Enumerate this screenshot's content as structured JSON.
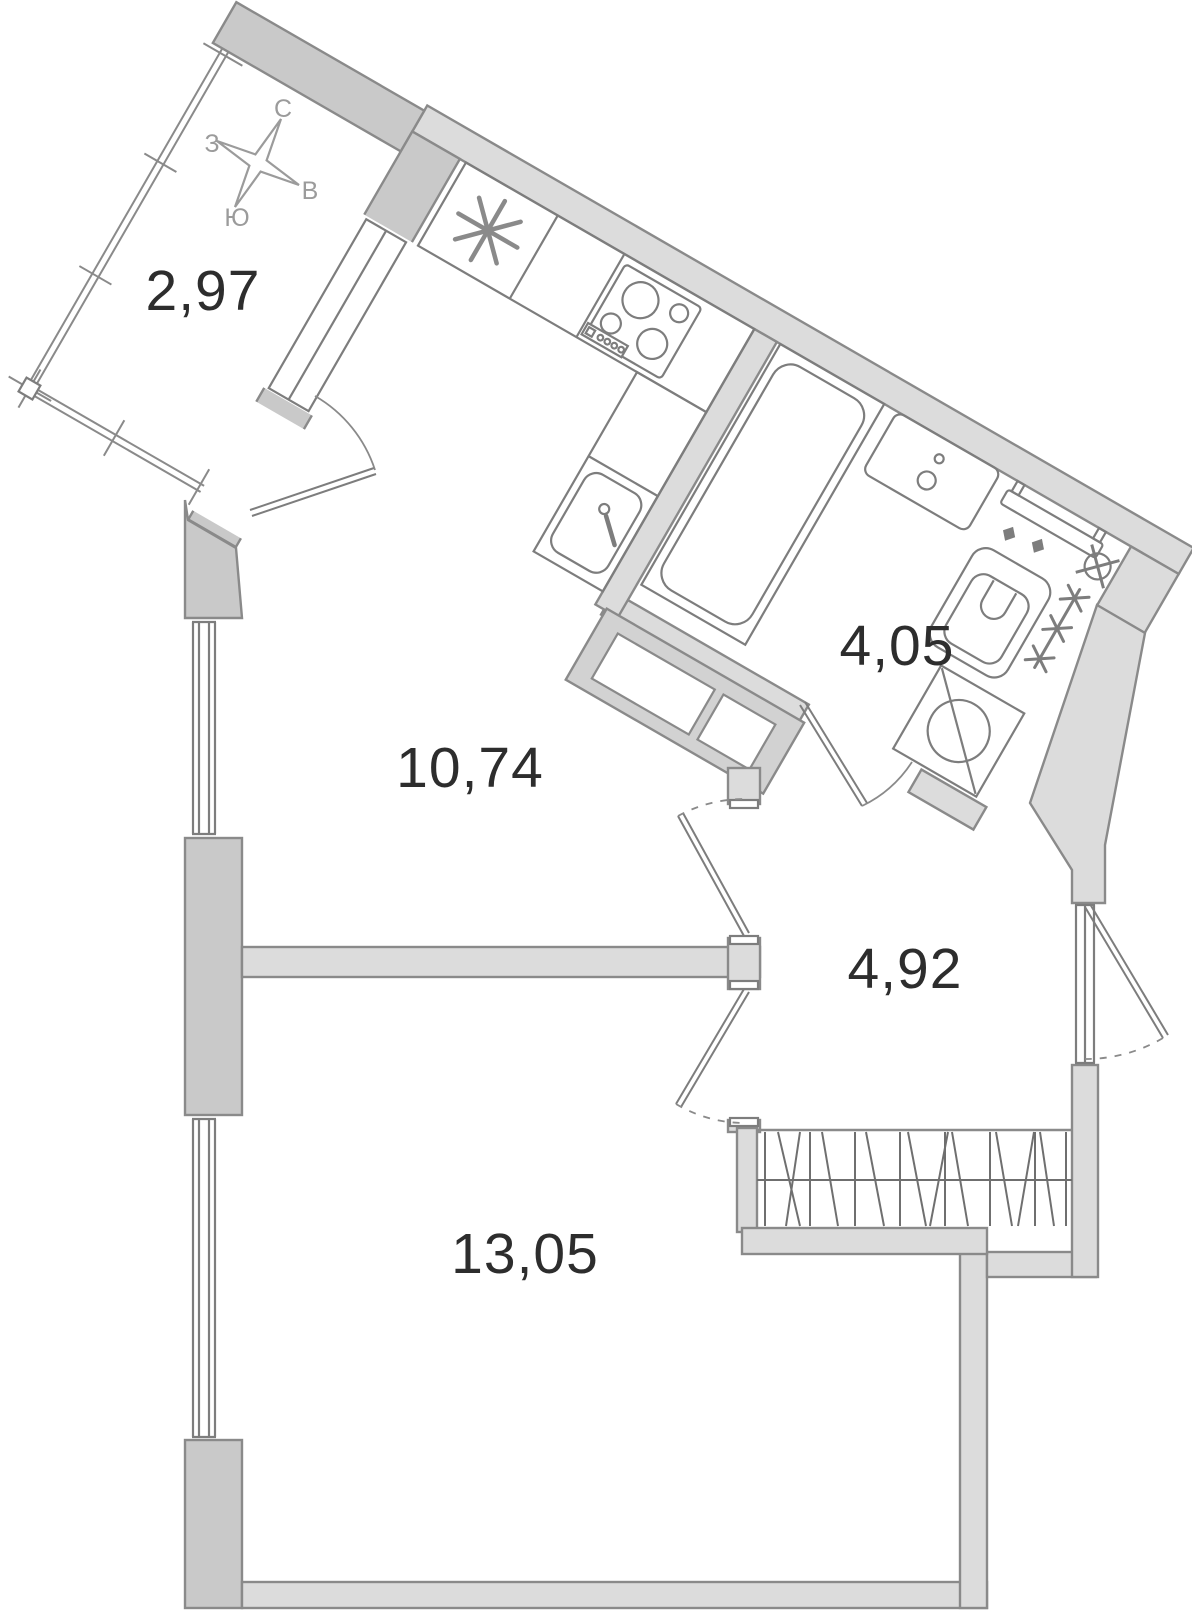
{
  "rooms": [
    {
      "name": "balcony",
      "area": "2,97"
    },
    {
      "name": "kitchen-living-room",
      "area": "10,74"
    },
    {
      "name": "bathroom",
      "area": "4,05"
    },
    {
      "name": "hallway",
      "area": "4,92"
    },
    {
      "name": "bedroom",
      "area": "13,05"
    }
  ],
  "compass": {
    "north": "С",
    "west": "З",
    "east": "В",
    "south": "Ю"
  },
  "colors": {
    "background": "#ffffff",
    "wall_light": "#dcdcdc",
    "wall_dark": "#c9c9c9",
    "wall_outline": "#8a8a8a",
    "fixture_line": "#7d7d7d",
    "label_text": "#2d2d2d",
    "compass_gray": "#9b9b9b"
  },
  "fixtures": [
    "fridge-icon",
    "stove-icon",
    "kitchen-sink-icon",
    "bathtub-icon",
    "washbasin-icon",
    "towel-rail-icon",
    "toilet-icon",
    "valve-icon",
    "ladder-radiator-icon",
    "washing-machine-icon",
    "wardrobe-icon",
    "vent-shaft",
    "compass-rose-icon"
  ]
}
